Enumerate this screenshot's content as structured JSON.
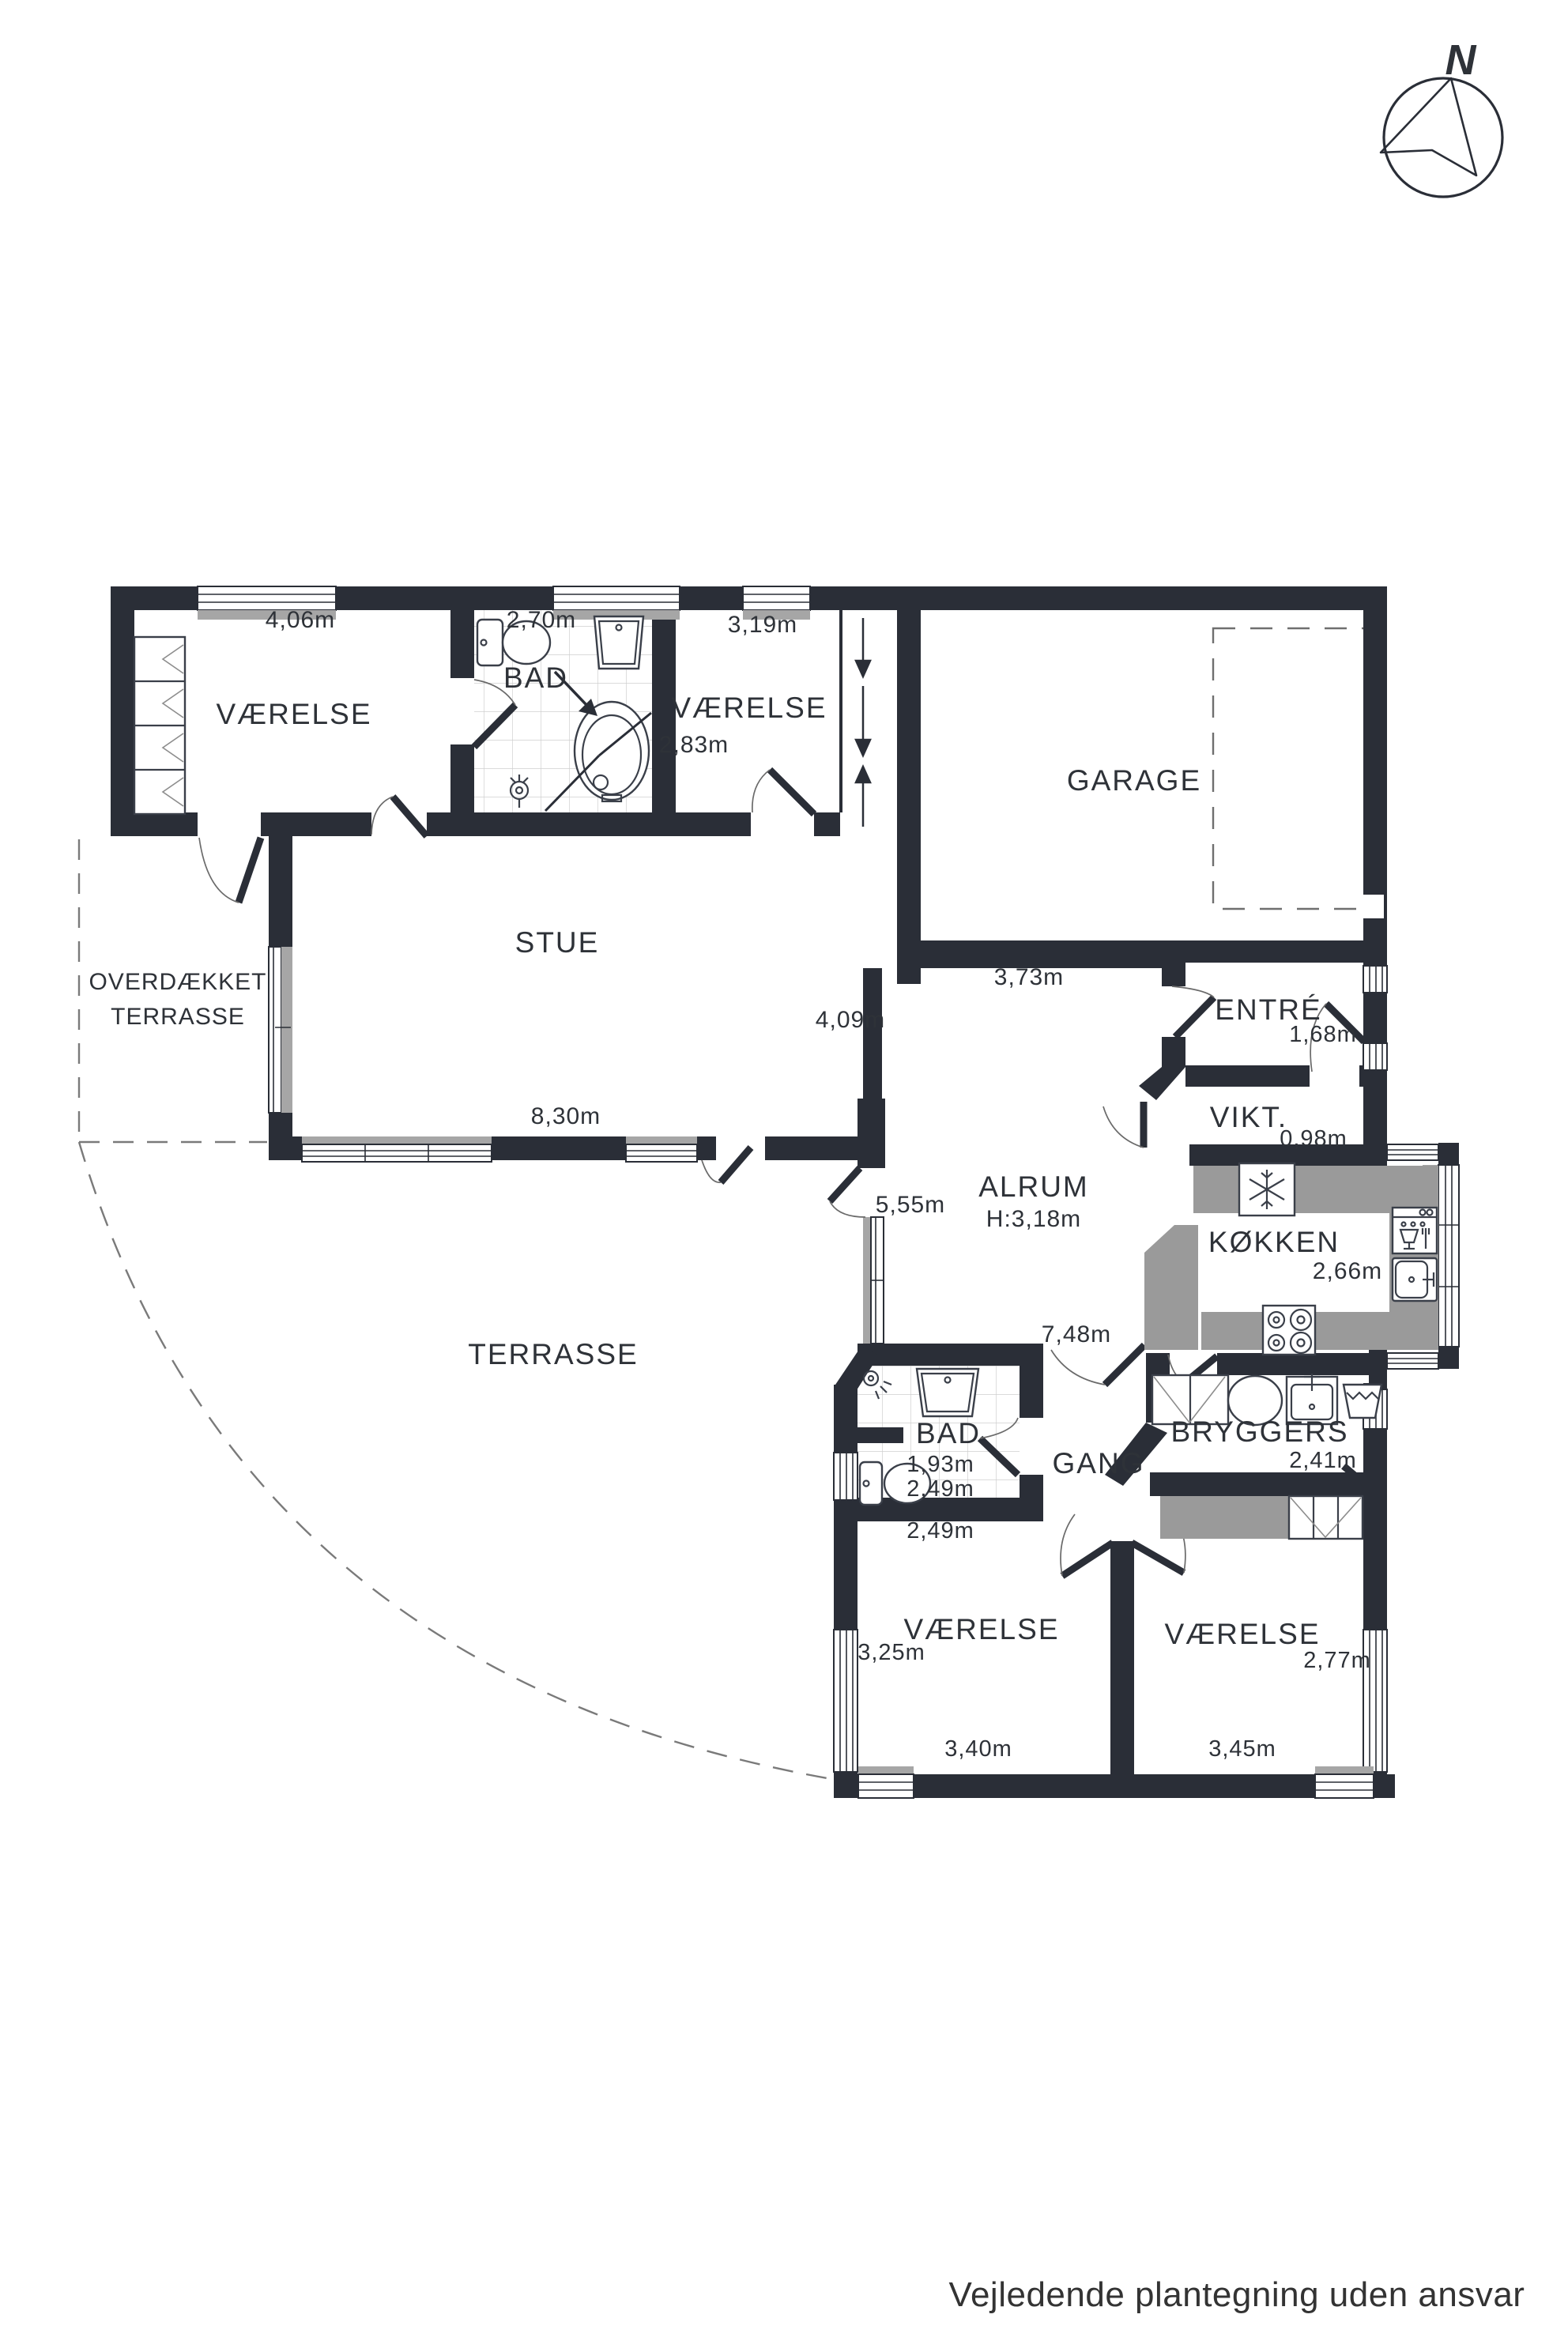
{
  "colors": {
    "wall": "#2a2e37",
    "counter_gray": "#9a9a9a",
    "window_sill_gray": "#a6a6a6",
    "text": "#2e3238"
  },
  "compass": {
    "north_label": "N"
  },
  "rooms": {
    "vaerelse_nw": {
      "name": "VÆRELSE",
      "width": "4,06m"
    },
    "bad_n": {
      "name": "BAD",
      "width": "2,70m"
    },
    "vaerelse_n": {
      "name": "VÆRELSE",
      "width": "3,19m",
      "depth": "2,83m"
    },
    "garage": {
      "name": "GARAGE"
    },
    "stue": {
      "name": "STUE",
      "width": "8,30m",
      "passage_width": "4,09m"
    },
    "overdaekket_terrasse": {
      "name_line1": "OVERDÆKKET",
      "name_line2": "TERRASSE"
    },
    "terrasse": {
      "name": "TERRASSE"
    },
    "alrum": {
      "name": "ALRUM",
      "ceiling_height": "H:3,18m",
      "width_top": "3,73m",
      "terrace_door_width": "5,55m",
      "width_bottom": "7,48m"
    },
    "entre": {
      "name": "ENTRÉ",
      "width": "1,68m"
    },
    "vikt": {
      "name": "VIKT.",
      "width": "0,98m"
    },
    "koekken": {
      "name": "KØKKEN",
      "width": "2,66m"
    },
    "bad_s": {
      "name": "BAD",
      "width_1": "1,93m",
      "width_2": "2,49m",
      "width_3": "2,49m"
    },
    "gang": {
      "name": "GANG"
    },
    "bryggers": {
      "name": "BRYGGERS",
      "width": "2,41m"
    },
    "vaerelse_sw": {
      "name": "VÆRELSE",
      "depth": "3,25m",
      "width": "3,40m"
    },
    "vaerelse_se": {
      "name": "VÆRELSE",
      "depth": "2,77m",
      "width": "3,45m"
    }
  },
  "footer": {
    "disclaimer": "Vejledende plantegning uden ansvar"
  }
}
